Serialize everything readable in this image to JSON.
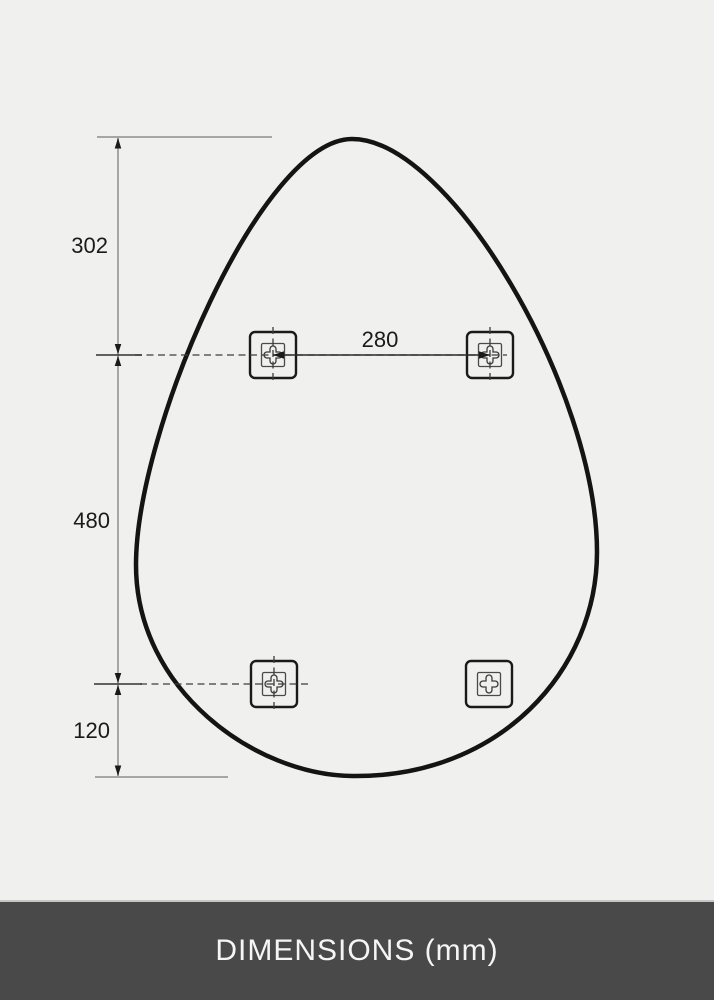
{
  "footer": {
    "label": "DIMENSIONS (mm)"
  },
  "dimensions": {
    "top_to_upper_brackets": "302",
    "upper_to_lower_brackets": "480",
    "lower_brackets_to_bottom": "120",
    "bracket_horizontal_spacing": "280"
  },
  "icons": {
    "mounting_bracket": "cross-keyhole-mounting-bracket-icon"
  },
  "colors": {
    "background": "#f0f0ef",
    "mirror_outline": "#141414",
    "dimension_guide_line": "#a6a6a6",
    "dimension_tick_line": "#4d4d4d",
    "centerline_dash": "#3c3c3c",
    "arrowhead": "#1a1a1a",
    "footer_background": "#494949",
    "footer_text": "#f5f5f5"
  }
}
